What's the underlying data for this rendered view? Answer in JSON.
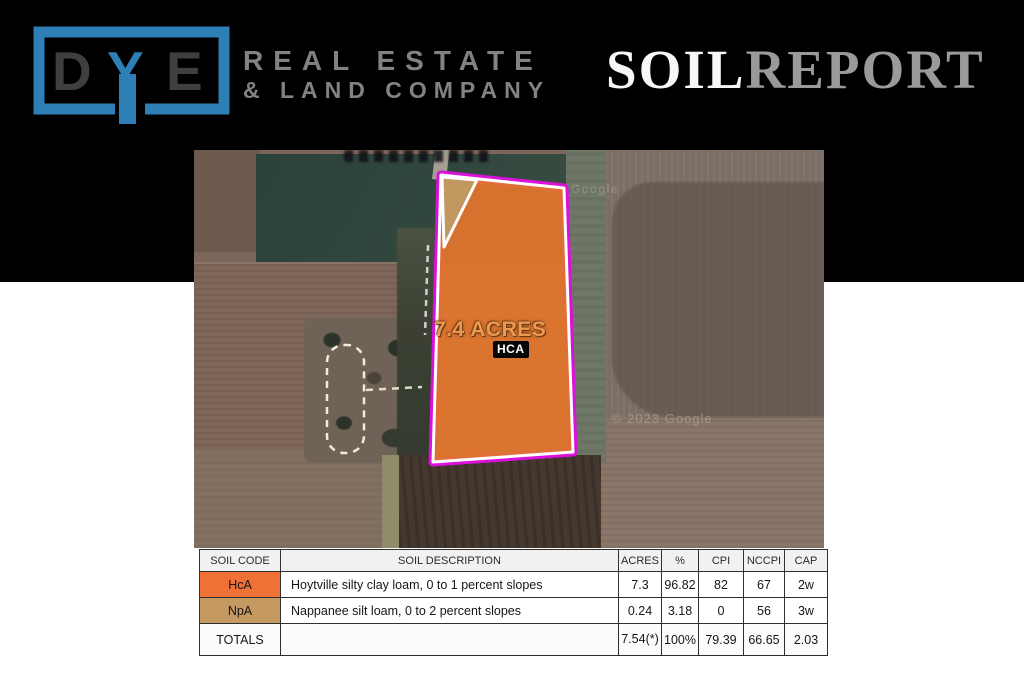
{
  "header": {
    "logo": {
      "d": "D",
      "y": "Y",
      "e": "E",
      "line1": "REAL ESTATE",
      "line2": "& LAND COMPANY",
      "accent_color": "#2d7fb5",
      "letters_color": "#3f3f3f",
      "text_color": "#828282"
    },
    "title": {
      "soil": "SOIL",
      "report": "REPORT",
      "soil_color": "#f7f7f7",
      "report_color": "#9a9a9a"
    }
  },
  "map": {
    "acreage_label": "7.4 ACRES",
    "parcel_code_label": "HCA",
    "watermark_upper": "Google",
    "watermark_lower": "© 2023 Google",
    "parcel_fill_color": "#e0752d",
    "parcel_border_color": "#d911d9",
    "secondary_soil_color": "#bf9a62"
  },
  "table": {
    "headers": [
      "SOIL CODE",
      "SOIL DESCRIPTION",
      "ACRES",
      "%",
      "CPI",
      "NCCPI",
      "CAP"
    ],
    "rows": [
      {
        "code": "HcA",
        "code_color": "#ef7135",
        "description": "Hoytville silty clay loam, 0 to 1 percent slopes",
        "acres": "7.3",
        "percent": "96.82",
        "cpi": "82",
        "nccpi": "67",
        "cap": "2w"
      },
      {
        "code": "NpA",
        "code_color": "#c49a62",
        "description": "Nappanee silt loam, 0 to 2 percent slopes",
        "acres": "0.24",
        "percent": "3.18",
        "cpi": "0",
        "nccpi": "56",
        "cap": "3w"
      }
    ],
    "totals": {
      "label": "TOTALS",
      "description": "",
      "acres": "7.54(*)",
      "percent": "100%",
      "cpi": "79.39",
      "nccpi": "66.65",
      "cap": "2.03"
    }
  }
}
